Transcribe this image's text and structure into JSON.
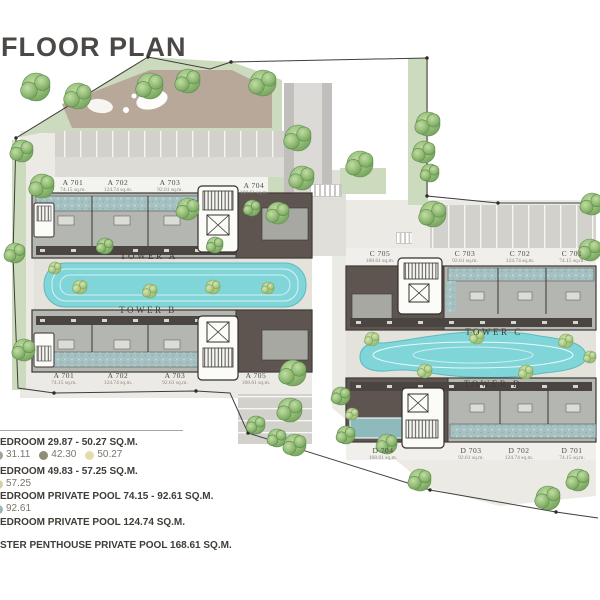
{
  "title": "FLOOR PLAN",
  "legend": {
    "rows": [
      {
        "header": "EDROOM 29.87 - 50.27 SQ.M.",
        "dots": [
          {
            "label": "31.11",
            "color": "#a3a190",
            "cut": true
          },
          {
            "label": "42.30",
            "color": "#8f8d74",
            "cut": false
          },
          {
            "label": "50.27",
            "color": "#e6dcaa",
            "cut": false
          }
        ]
      },
      {
        "header": "EDROOM 49.83 - 57.25 SQ.M.",
        "dots": [
          {
            "label": "57.25",
            "color": "#d9cf9e",
            "cut": true
          }
        ]
      },
      {
        "header": "EDROOM PRIVATE POOL 74.15 - 92.61 SQ.M.",
        "dots": [
          {
            "label": "92.61",
            "color": "#9fb5b3",
            "cut": true
          }
        ]
      },
      {
        "header": "EDROOM PRIVATE POOL 124.74 SQ.M.",
        "dots": []
      },
      {
        "header": "STER PENTHOUSE PRIVATE POOL 168.61 SQ.M.",
        "dots": []
      }
    ]
  },
  "towers": [
    {
      "name": "TOWER A",
      "name_pos": [
        149,
        251
      ],
      "units": [
        {
          "id": "A 701",
          "area": "74.15 sq.m.",
          "pos": [
            73,
            179
          ]
        },
        {
          "id": "A 702",
          "area": "124.74 sq.m.",
          "pos": [
            118,
            179
          ]
        },
        {
          "id": "A 703",
          "area": "92.61 sq.m.",
          "pos": [
            170,
            179
          ]
        },
        {
          "id": "A 704",
          "area": "168.61 sq.m.",
          "pos": [
            254,
            182
          ]
        }
      ]
    },
    {
      "name": "TOWER B",
      "name_pos": [
        148,
        305
      ],
      "units": [
        {
          "id": "A 701",
          "area": "74.15 sq.m.",
          "pos": [
            64,
            372
          ]
        },
        {
          "id": "A 702",
          "area": "124.74 sq.m.",
          "pos": [
            118,
            372
          ]
        },
        {
          "id": "A 703",
          "area": "92.61 sq.m.",
          "pos": [
            175,
            372
          ]
        },
        {
          "id": "A 705",
          "area": "168.61 sq.m.",
          "pos": [
            256,
            372
          ]
        }
      ]
    },
    {
      "name": "TOWER C",
      "name_pos": [
        494,
        327
      ],
      "units": [
        {
          "id": "C 705",
          "area": "168.61 sq.m.",
          "pos": [
            380,
            250
          ]
        },
        {
          "id": "C 703",
          "area": "92.61 sq.m.",
          "pos": [
            465,
            250
          ]
        },
        {
          "id": "C 702",
          "area": "124.74 sq.m.",
          "pos": [
            520,
            250
          ]
        },
        {
          "id": "C 701",
          "area": "74.15 sq.m.",
          "pos": [
            572,
            250
          ]
        }
      ]
    },
    {
      "name": "TOWER D",
      "name_pos": [
        493,
        379
      ],
      "units": [
        {
          "id": "D 704",
          "area": "168.61 sq.m.",
          "pos": [
            383,
            447
          ]
        },
        {
          "id": "D 703",
          "area": "92.61 sq.m.",
          "pos": [
            471,
            447
          ]
        },
        {
          "id": "D 702",
          "area": "124.74 sq.m.",
          "pos": [
            519,
            447
          ]
        },
        {
          "id": "D 701",
          "area": "74.15 sq.m.",
          "pos": [
            572,
            447
          ]
        }
      ]
    }
  ],
  "colors": {
    "pool": "#80d5d9",
    "private_pool": "#a6c1c2",
    "building_gray": "#b3b6b1",
    "building_dark": "#5e5550",
    "tree_green": "#93bd76",
    "title_text": "#4b4845"
  },
  "scene": {
    "trees": [
      [
        36,
        87,
        14
      ],
      [
        78,
        96,
        13
      ],
      [
        150,
        86,
        13
      ],
      [
        188,
        81,
        12
      ],
      [
        263,
        83,
        13
      ],
      [
        22,
        151,
        11
      ],
      [
        15,
        253,
        10
      ],
      [
        24,
        350,
        11
      ],
      [
        42,
        186,
        12
      ],
      [
        188,
        209,
        11
      ],
      [
        252,
        208,
        8
      ],
      [
        278,
        213,
        11
      ],
      [
        105,
        246,
        8
      ],
      [
        215,
        245,
        8
      ],
      [
        293,
        373,
        13
      ],
      [
        298,
        138,
        13
      ],
      [
        302,
        178,
        12
      ],
      [
        360,
        164,
        13
      ],
      [
        428,
        124,
        12
      ],
      [
        424,
        152,
        11
      ],
      [
        430,
        173,
        9
      ],
      [
        433,
        214,
        13
      ],
      [
        592,
        204,
        11
      ],
      [
        590,
        250,
        11
      ],
      [
        341,
        396,
        9
      ],
      [
        290,
        410,
        12
      ],
      [
        256,
        425,
        9
      ],
      [
        277,
        438,
        9
      ],
      [
        295,
        445,
        11
      ],
      [
        346,
        435,
        9
      ],
      [
        387,
        444,
        10
      ],
      [
        420,
        480,
        11
      ],
      [
        548,
        498,
        12
      ],
      [
        578,
        480,
        11
      ]
    ],
    "bushes": [
      [
        80,
        287,
        7
      ],
      [
        150,
        291,
        7
      ],
      [
        213,
        287,
        7
      ],
      [
        268,
        288,
        6
      ],
      [
        55,
        268,
        6
      ],
      [
        372,
        339,
        7
      ],
      [
        425,
        371,
        7
      ],
      [
        477,
        337,
        7
      ],
      [
        526,
        372,
        7
      ],
      [
        566,
        341,
        7
      ],
      [
        590,
        357,
        6
      ],
      [
        352,
        414,
        6
      ]
    ]
  }
}
